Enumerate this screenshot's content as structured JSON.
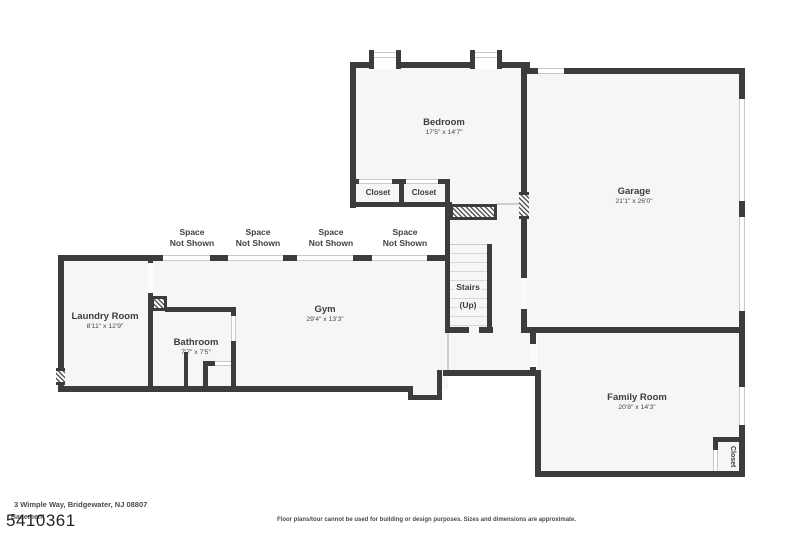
{
  "rooms": {
    "bedroom": {
      "name": "Bedroom",
      "dims": "17'5\" x 14'7\""
    },
    "garage": {
      "name": "Garage",
      "dims": "21'1\" x 26'0\""
    },
    "laundry": {
      "name": "Laundry Room",
      "dims": "8'11\" x 12'9\""
    },
    "bathroom": {
      "name": "Bathroom",
      "dims": "7'7\" x 7'5\""
    },
    "gym": {
      "name": "Gym",
      "dims": "29'4\" x 13'3\""
    },
    "family": {
      "name": "Family Room",
      "dims": "20'8\" x 14'3\""
    },
    "stairs": {
      "name": "Stairs",
      "sub": "(Up)"
    }
  },
  "labels": {
    "closet": "Closet",
    "space_not_shown": "Space\nNot Shown"
  },
  "footer": {
    "address": "3 Wimple Way, Bridgewater, NJ 08807",
    "floor_label": "Basement",
    "mls_number": "5410361",
    "disclaimer": "Floor plans/tour cannot be used for building or design purposes. Sizes and dimensions are approximate."
  },
  "colors": {
    "wall": "#3c3c3e",
    "floor_fill": "#f6f6f7",
    "window_line": "#c9c9cd",
    "text": "#3d3d3f"
  }
}
